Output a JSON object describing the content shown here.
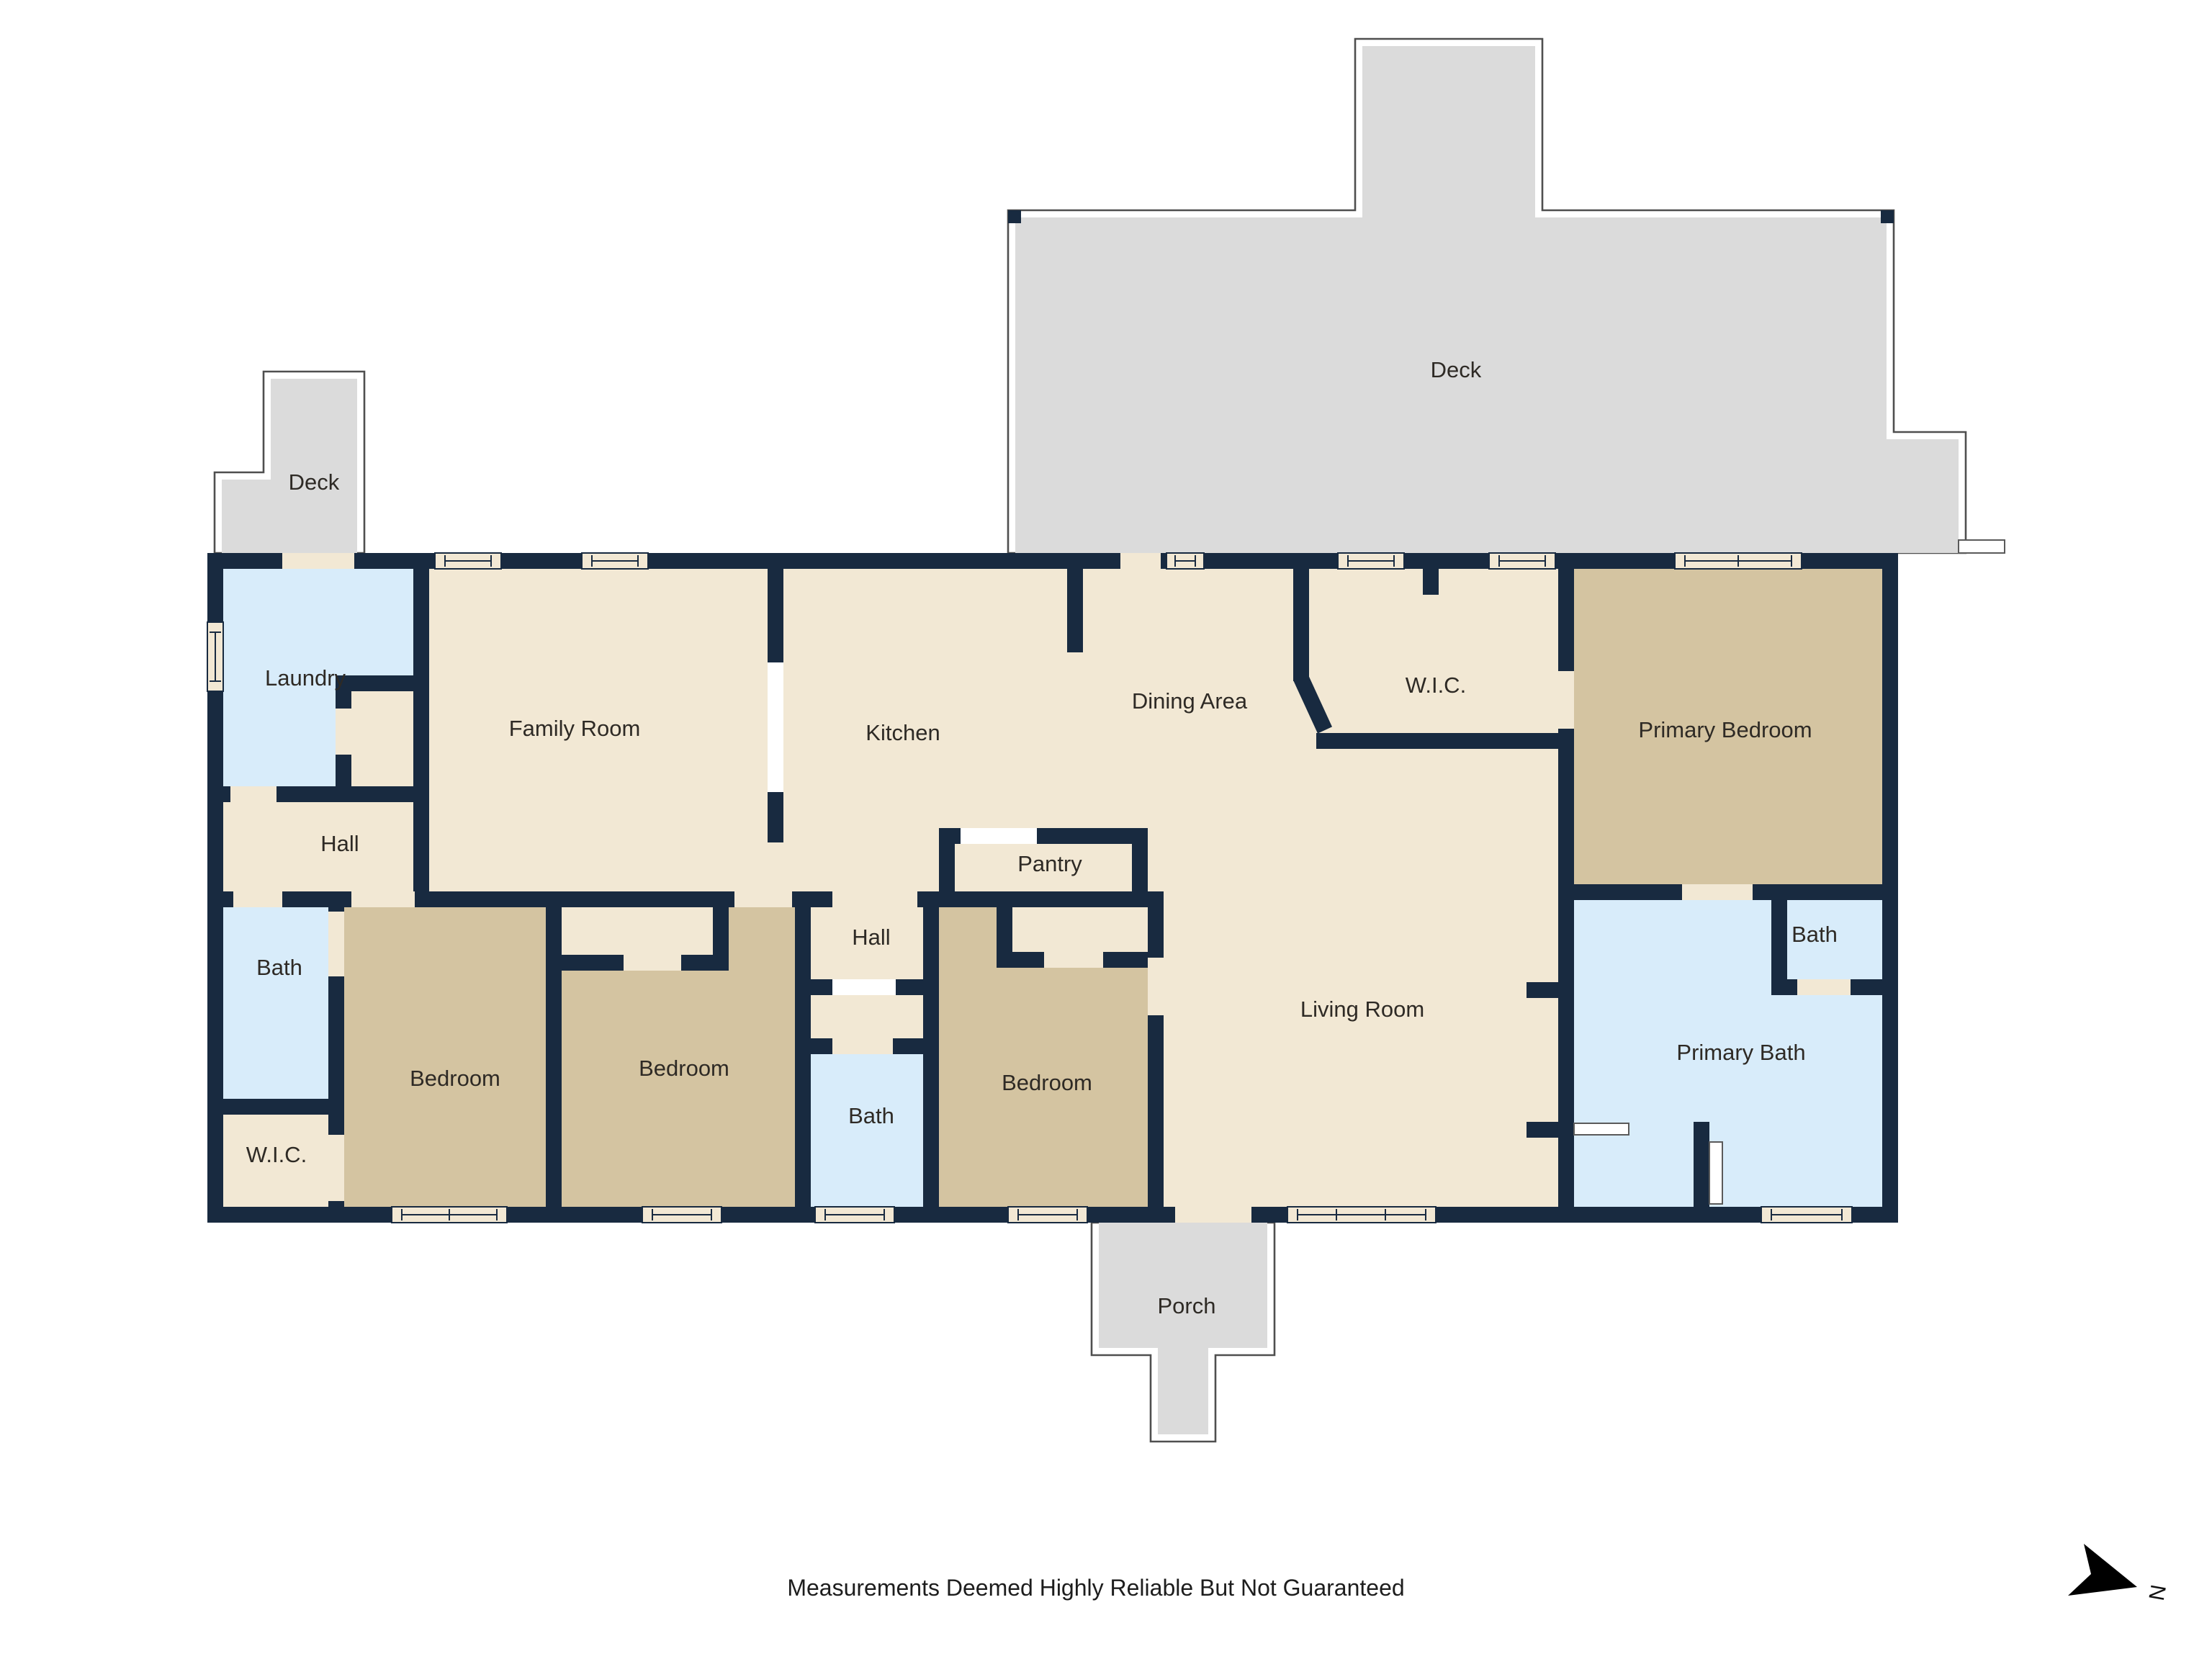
{
  "footer": {
    "disclaimer": "Measurements Deemed Highly Reliable But Not Guaranteed"
  },
  "compass": {
    "north_label": "N"
  },
  "colors": {
    "wall": "#182a40",
    "floor_cream": "#f2e8d4",
    "floor_tan": "#d4c4a1",
    "floor_blue": "#d8ecfa",
    "deck_fill": "#dbdbdb",
    "deck_outline": "#4f4f4f",
    "label_text": "#2e2a25"
  },
  "rooms": {
    "deck_small": {
      "label": "Deck"
    },
    "deck_large": {
      "label": "Deck"
    },
    "laundry": {
      "label": "Laundry"
    },
    "family_room": {
      "label": "Family Room"
    },
    "kitchen": {
      "label": "Kitchen"
    },
    "dining_area": {
      "label": "Dining Area"
    },
    "wic_upper": {
      "label": "W.I.C."
    },
    "primary_bedroom": {
      "label": "Primary Bedroom"
    },
    "hall_left": {
      "label": "Hall"
    },
    "bath_left": {
      "label": "Bath"
    },
    "wic_lower": {
      "label": "W.I.C."
    },
    "bedroom_left": {
      "label": "Bedroom"
    },
    "bedroom_middle": {
      "label": "Bedroom"
    },
    "hall_middle": {
      "label": "Hall"
    },
    "pantry": {
      "label": "Pantry"
    },
    "bath_middle": {
      "label": "Bath"
    },
    "bedroom_right": {
      "label": "Bedroom"
    },
    "living_room": {
      "label": "Living Room"
    },
    "primary_bath": {
      "label": "Primary Bath"
    },
    "bath_right": {
      "label": "Bath"
    },
    "porch": {
      "label": "Porch"
    }
  }
}
